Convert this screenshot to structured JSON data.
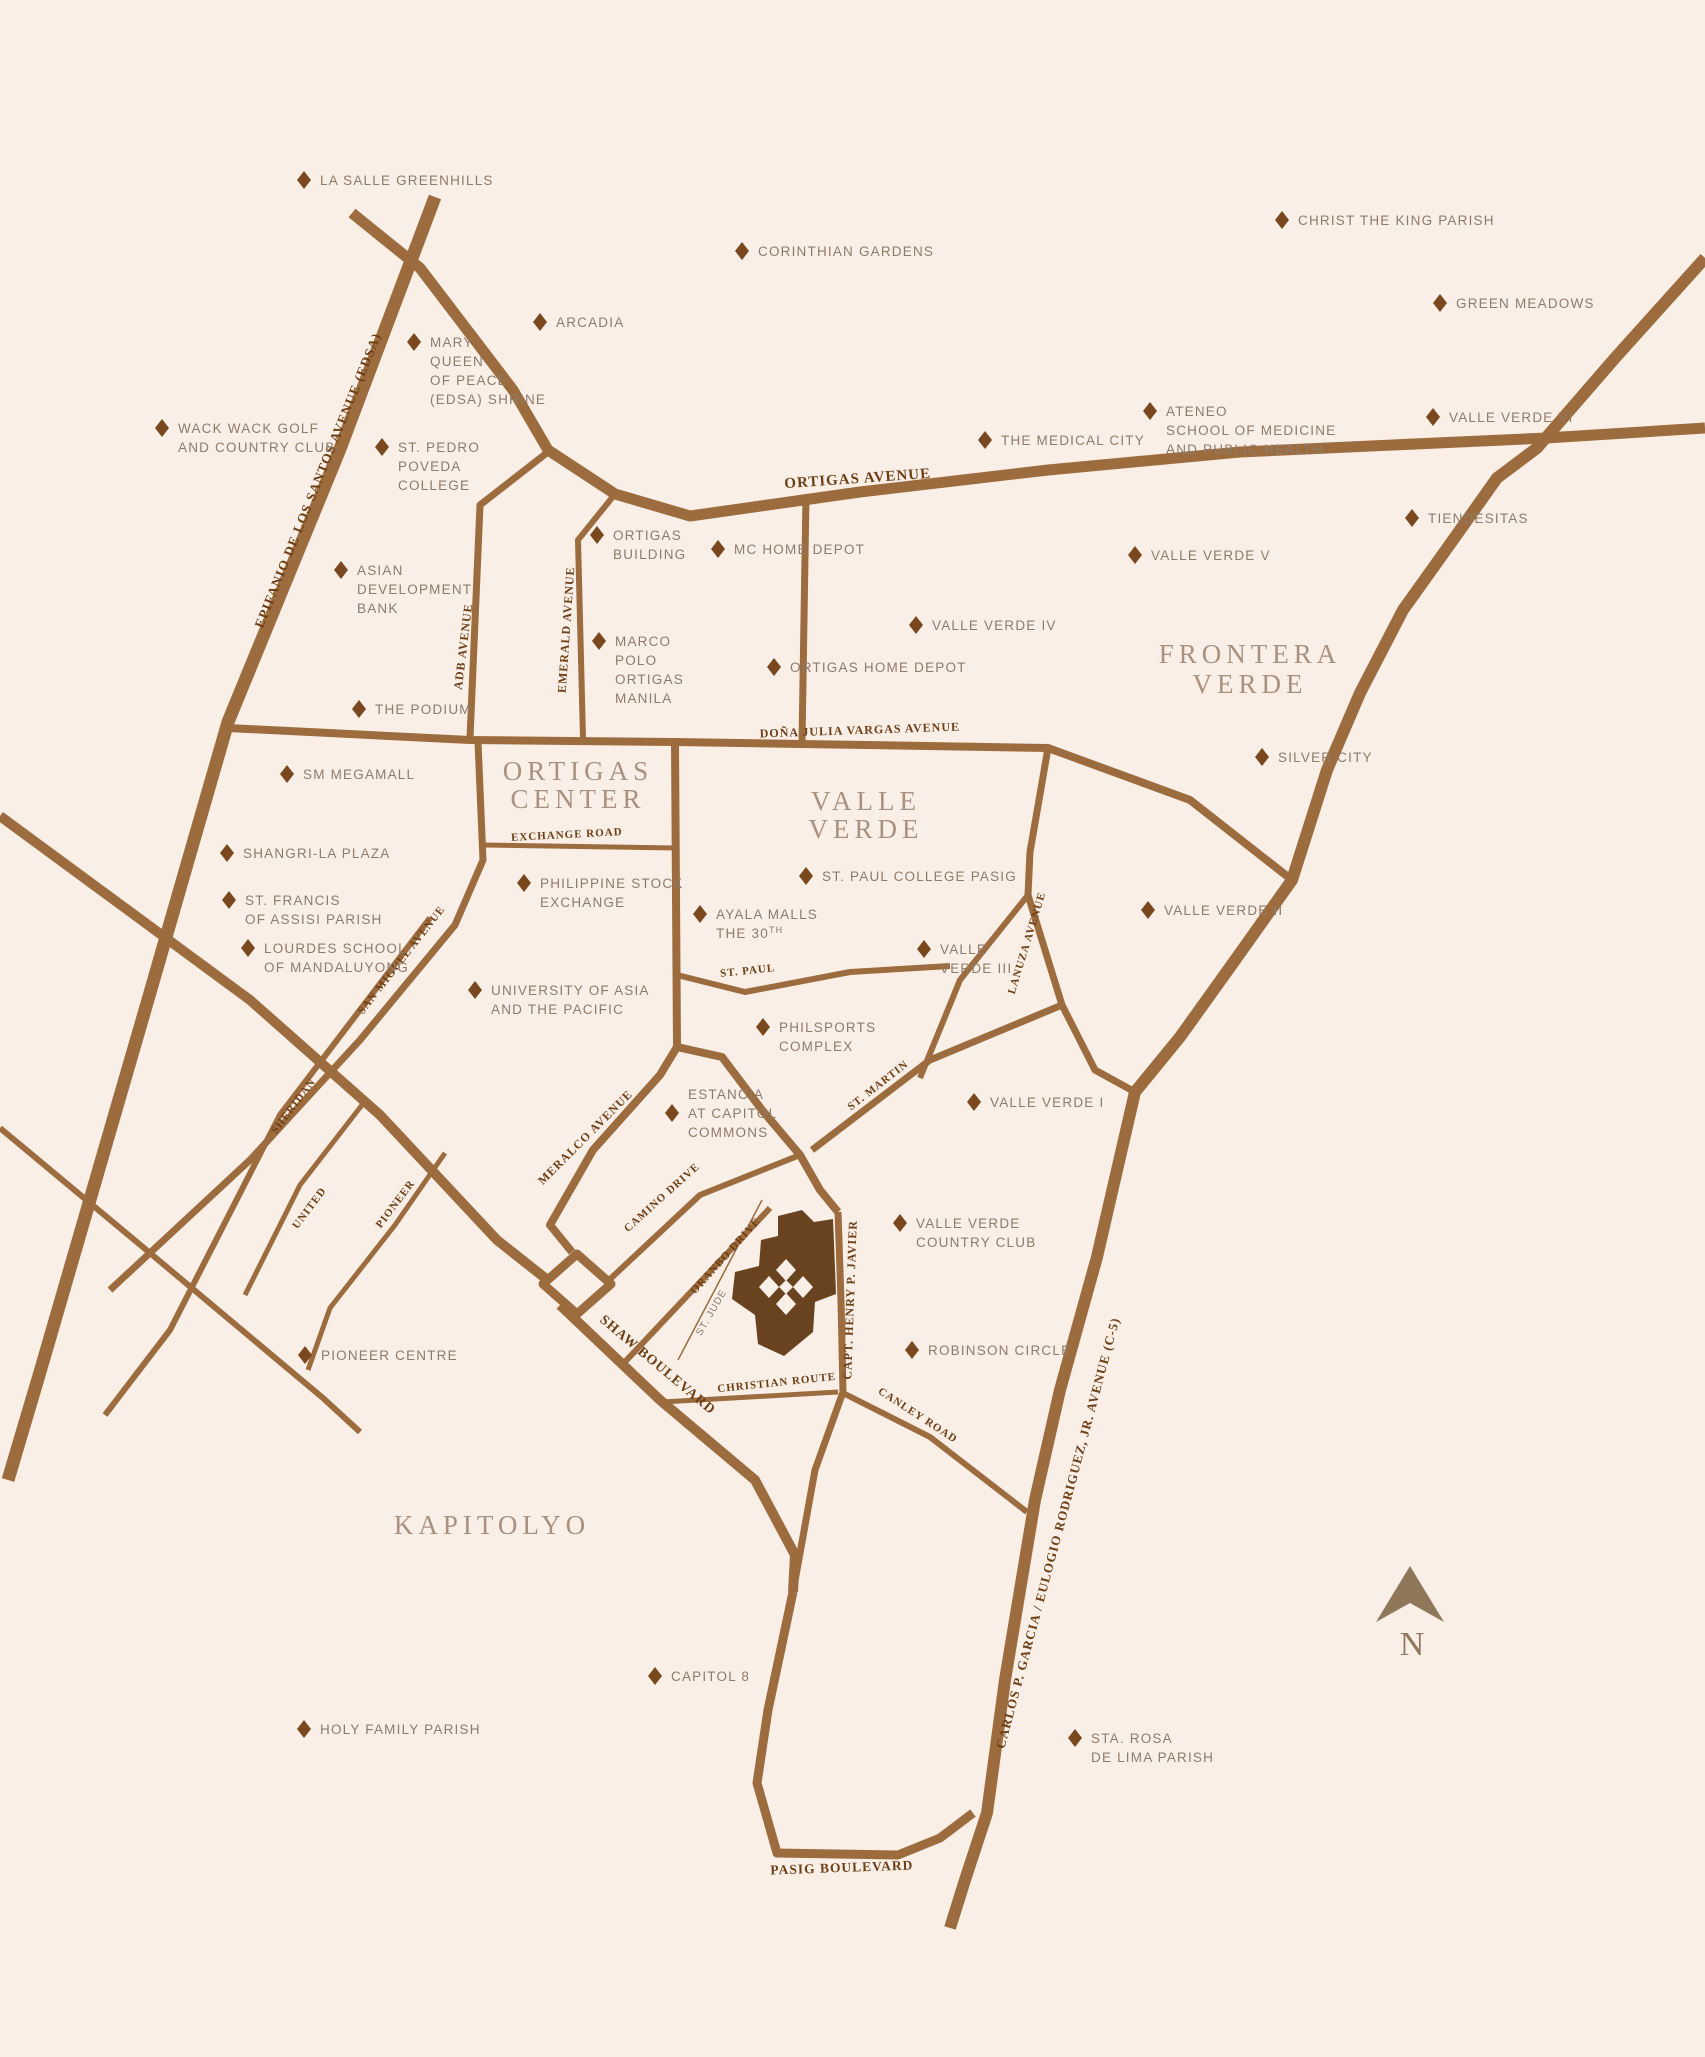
{
  "map": {
    "colors": {
      "bg": "#FAEFE7",
      "road": "#9C6C3E",
      "roadLabel": "#6E3F15",
      "poiDiamond": "#79481F",
      "poiText": "#8D7B6B",
      "areaText": "#A8917E",
      "site": "#69431F",
      "compass": "#91775A"
    },
    "areas": [
      {
        "name": "ORTIGAS CENTER",
        "lines": [
          "ORTIGAS",
          "CENTER"
        ]
      },
      {
        "name": "VALLE VERDE",
        "lines": [
          "VALLE",
          "VERDE"
        ]
      },
      {
        "name": "FRONTERA VERDE",
        "lines": [
          "FRONTERA",
          "VERDE"
        ]
      },
      {
        "name": "KAPITOLYO",
        "lines": [
          "KAPITOLYO"
        ]
      }
    ],
    "road_labels": [
      {
        "label": "ORTIGAS AVENUE"
      },
      {
        "label": "EPIFANIO DE LOS SANTOS AVENUE (EDSA)"
      },
      {
        "label": "ADB AVENUE"
      },
      {
        "label": "EMERALD AVENUE"
      },
      {
        "label": "DOÑA JULIA VARGAS AVENUE"
      },
      {
        "label": "EXCHANGE ROAD"
      },
      {
        "label": "SAN MIGUEL AVENUE"
      },
      {
        "label": "ST. PAUL"
      },
      {
        "label": "LANUZA AVENUE"
      },
      {
        "label": "ST. MARTIN"
      },
      {
        "label": "MERALCO AVENUE"
      },
      {
        "label": "SHERIDAN"
      },
      {
        "label": "UNITED"
      },
      {
        "label": "PIONEER"
      },
      {
        "label": "CAMINO DRIVE"
      },
      {
        "label": "ORANBO DRIVE"
      },
      {
        "label": "ST. JUDE"
      },
      {
        "label": "CAPT. HENRY P. JAVIER"
      },
      {
        "label": "SHAW BOULEVARD"
      },
      {
        "label": "CHRISTIAN ROUTE"
      },
      {
        "label": "CANLEY ROAD"
      },
      {
        "label": "CARLOS P. GARCIA / EULOGIO RODRIGUEZ, JR. AVENUE (C-5)"
      },
      {
        "label": "PASIG BOULEVARD"
      }
    ],
    "pois": [
      {
        "label": "LA SALLE GREENHILLS",
        "lines": [
          "LA SALLE GREENHILLS"
        ]
      },
      {
        "label": "CHRIST THE KING PARISH",
        "lines": [
          "CHRIST THE KING PARISH"
        ]
      },
      {
        "label": "CORINTHIAN GARDENS",
        "lines": [
          "CORINTHIAN GARDENS"
        ]
      },
      {
        "label": "GREEN MEADOWS",
        "lines": [
          "GREEN MEADOWS"
        ]
      },
      {
        "label": "ARCADIA",
        "lines": [
          "ARCADIA"
        ]
      },
      {
        "label": "MARY QUEEN OF PEACE (EDSA) SHRINE",
        "lines": [
          "MARY",
          "QUEEN",
          "OF PEACE",
          "(EDSA) SHRINE"
        ]
      },
      {
        "label": "WACK WACK GOLF AND COUNTRY CLUB",
        "lines": [
          "WACK WACK GOLF",
          "AND COUNTRY CLUB"
        ]
      },
      {
        "label": "ATENEO SCHOOL OF MEDICINE AND PUBLIC HEALTH",
        "lines": [
          "ATENEO",
          "SCHOOL OF MEDICINE",
          "AND PUBLIC HEALTH"
        ]
      },
      {
        "label": "THE MEDICAL CITY",
        "lines": [
          "THE MEDICAL CITY"
        ]
      },
      {
        "label": "VALLE VERDE VI",
        "lines": [
          "VALLE VERDE VI"
        ]
      },
      {
        "label": "ST. PEDRO POVEDA COLLEGE",
        "lines": [
          "ST. PEDRO",
          "POVEDA",
          "COLLEGE"
        ]
      },
      {
        "label": "TIENDESITAS",
        "lines": [
          "TIENDESITAS"
        ]
      },
      {
        "label": "ORTIGAS BUILDING",
        "lines": [
          "ORTIGAS",
          "BUILDING"
        ]
      },
      {
        "label": "MC HOME DEPOT",
        "lines": [
          "MC HOME DEPOT"
        ]
      },
      {
        "label": "VALLE VERDE V",
        "lines": [
          "VALLE VERDE V"
        ]
      },
      {
        "label": "ASIAN DEVELOPMENT BANK",
        "lines": [
          "ASIAN",
          "DEVELOPMENT",
          "BANK"
        ]
      },
      {
        "label": "VALLE VERDE IV",
        "lines": [
          "VALLE VERDE IV"
        ]
      },
      {
        "label": "MARCO POLO ORTIGAS MANILA",
        "lines": [
          "MARCO",
          "POLO",
          "ORTIGAS",
          "MANILA"
        ]
      },
      {
        "label": "ORTIGAS HOME DEPOT",
        "lines": [
          "ORTIGAS HOME DEPOT"
        ]
      },
      {
        "label": "THE PODIUM",
        "lines": [
          "THE PODIUM"
        ]
      },
      {
        "label": "SM MEGAMALL",
        "lines": [
          "SM MEGAMALL"
        ]
      },
      {
        "label": "SILVER CITY",
        "lines": [
          "SILVER CITY"
        ]
      },
      {
        "label": "SHANGRI-LA PLAZA",
        "lines": [
          "SHANGRI-LA PLAZA"
        ]
      },
      {
        "label": "ST. PAUL COLLEGE PASIG",
        "lines": [
          "ST. PAUL COLLEGE PASIG"
        ]
      },
      {
        "label": "PHILIPPINE STOCK EXCHANGE",
        "lines": [
          "PHILIPPINE STOCK",
          "EXCHANGE"
        ]
      },
      {
        "label": "ST. FRANCIS OF ASSISI PARISH",
        "lines": [
          "ST. FRANCIS",
          "OF ASSISI PARISH"
        ]
      },
      {
        "label": "VALLE VERDE II",
        "lines": [
          "VALLE VERDE II"
        ]
      },
      {
        "label": "AYALA MALLS THE 30TH",
        "lines": [
          "AYALA MALLS",
          "THE 30"
        ],
        "sup": "TH"
      },
      {
        "label": "LOURDES SCHOOL OF MANDALUYONG",
        "lines": [
          "LOURDES SCHOOL",
          "OF MANDALUYONG"
        ]
      },
      {
        "label": "VALLE VERDE III",
        "lines": [
          "VALLE",
          "VERDE III"
        ]
      },
      {
        "label": "UNIVERSITY OF ASIA AND THE PACIFIC",
        "lines": [
          "UNIVERSITY OF ASIA",
          "AND THE PACIFIC"
        ]
      },
      {
        "label": "PHILSPORTS COMPLEX",
        "lines": [
          "PHILSPORTS",
          "COMPLEX"
        ]
      },
      {
        "label": "ESTANCIA AT CAPITOL COMMONS",
        "lines": [
          "ESTANCIA",
          "AT CAPITOL",
          "COMMONS"
        ]
      },
      {
        "label": "VALLE VERDE I",
        "lines": [
          "VALLE VERDE I"
        ]
      },
      {
        "label": "VALLE VERDE COUNTRY CLUB",
        "lines": [
          "VALLE VERDE",
          "COUNTRY CLUB"
        ]
      },
      {
        "label": "PIONEER CENTRE",
        "lines": [
          "PIONEER CENTRE"
        ]
      },
      {
        "label": "ROBINSON CIRCLE",
        "lines": [
          "ROBINSON CIRCLE"
        ]
      },
      {
        "label": "CAPITOL 8",
        "lines": [
          "CAPITOL 8"
        ]
      },
      {
        "label": "HOLY FAMILY PARISH",
        "lines": [
          "HOLY FAMILY PARISH"
        ]
      },
      {
        "label": "STA. ROSA DE LIMA PARISH",
        "lines": [
          "STA. ROSA",
          "DE LIMA PARISH"
        ]
      }
    ],
    "compass": {
      "label": "N"
    }
  }
}
